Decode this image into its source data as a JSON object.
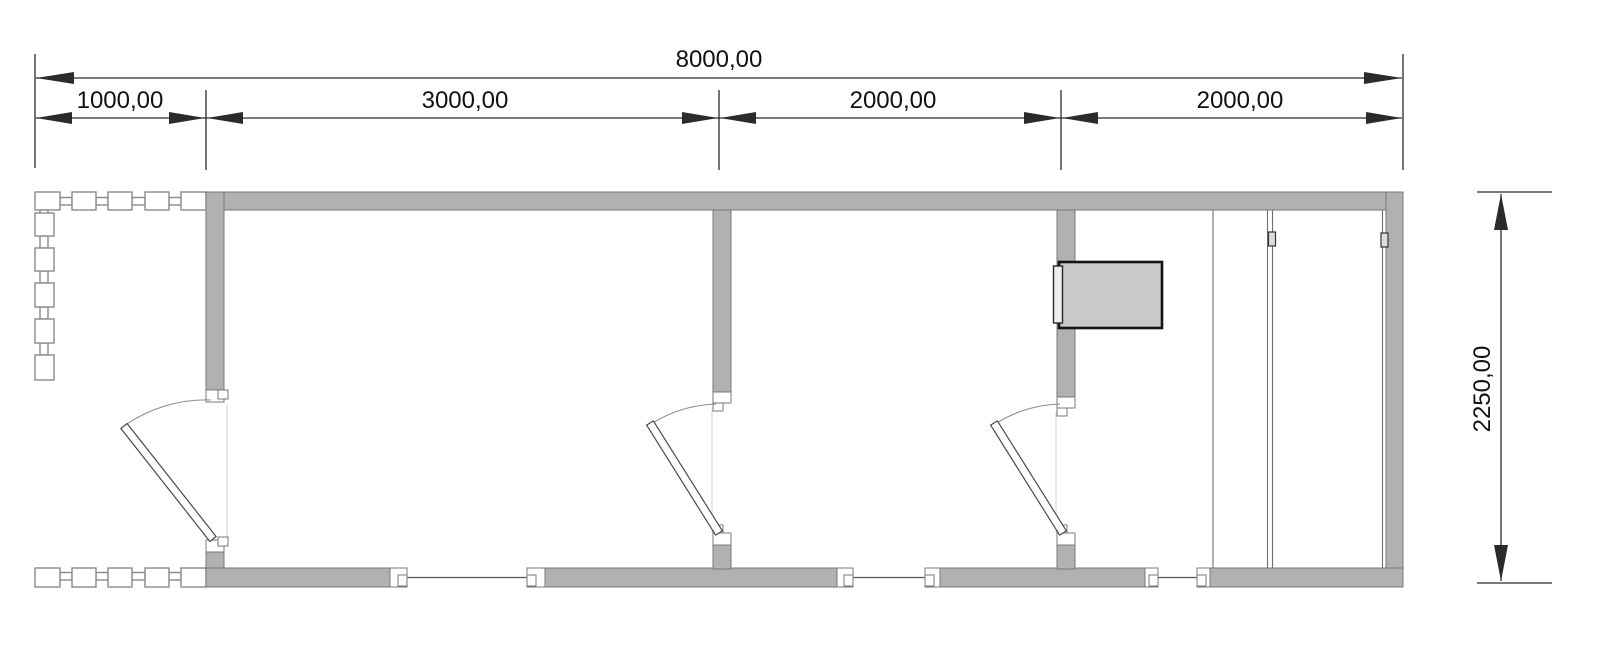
{
  "dimensions": {
    "total": {
      "label": "8000,00",
      "value_mm": 8000
    },
    "segments": [
      {
        "label": "1000,00",
        "value_mm": 1000
      },
      {
        "label": "3000,00",
        "value_mm": 3000
      },
      {
        "label": "2000,00",
        "value_mm": 2000
      },
      {
        "label": "2000,00",
        "value_mm": 2000
      }
    ],
    "height": {
      "label": "2250,00",
      "value_mm": 2250
    }
  },
  "colors": {
    "background": "#ffffff",
    "wall_fill": "#b1b1b1",
    "wall_outline": "#787878",
    "dimension_line": "#2b2b2b",
    "text": "#111111",
    "appliance_fill": "#c9c9c9",
    "appliance_outline": "#141414"
  }
}
